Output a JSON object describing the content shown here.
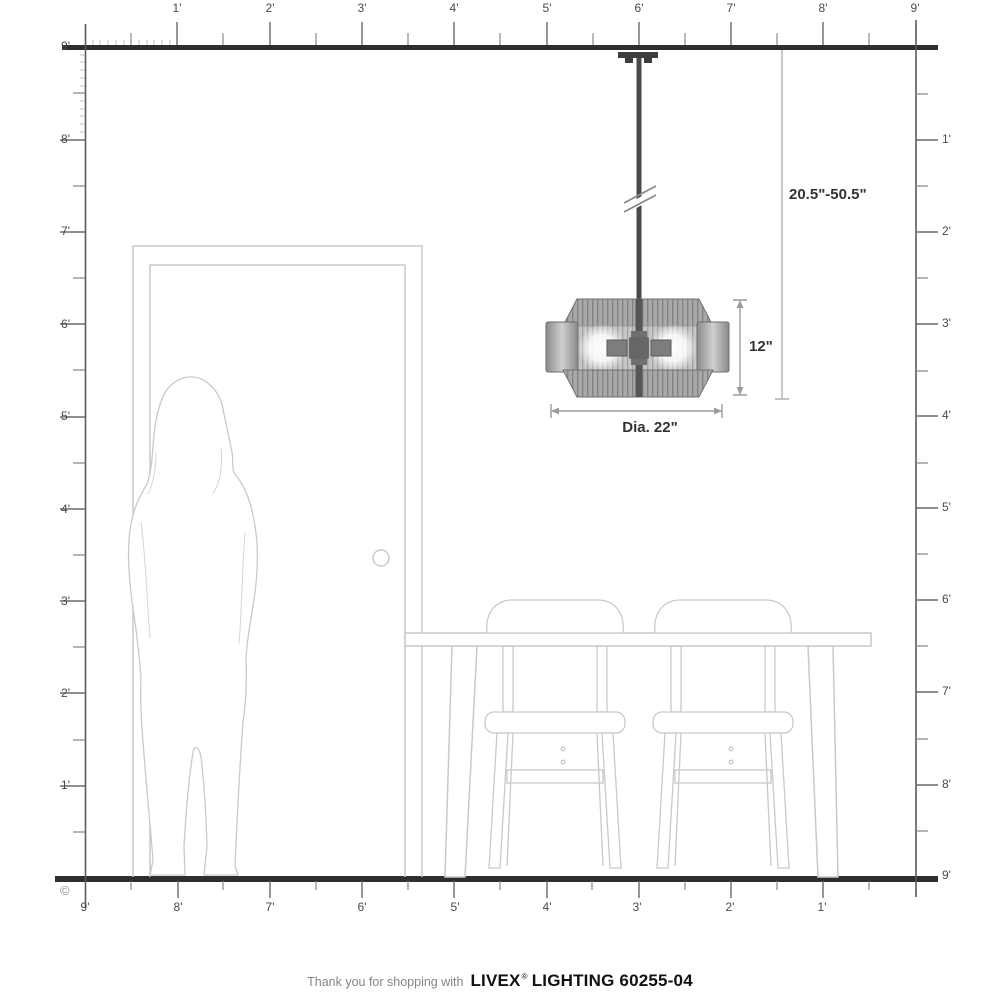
{
  "rulers": {
    "top_labels": [
      "1'",
      "2'",
      "3'",
      "4'",
      "5'",
      "6'",
      "7'",
      "8'",
      "9'"
    ],
    "left_labels": [
      "9'",
      "8'",
      "7'",
      "6'",
      "5'",
      "4'",
      "3'",
      "2'",
      "1'"
    ],
    "right_labels": [
      "1'",
      "2'",
      "3'",
      "4'",
      "5'",
      "6'",
      "7'",
      "8'",
      "9'"
    ],
    "bottom_labels": [
      "9'",
      "8'",
      "7'",
      "6'",
      "5'",
      "4'",
      "3'",
      "2'",
      "1'"
    ],
    "copyright": "©"
  },
  "dimensions": {
    "hang_range": "20.5\"-50.5\"",
    "fixture_height": "12\"",
    "diameter": "Dia. 22\""
  },
  "footer": {
    "prefix": "Thank you for shopping with",
    "brand": "LIVEX",
    "registered": "®",
    "product": "LIGHTING 60255-04"
  },
  "colors": {
    "structure_line": "#2e2e2e",
    "ruler_tick": "#6a6a6a",
    "furniture_line": "#c9c9c9",
    "dimension_line": "#b0b0b0",
    "dimension_text": "#333333",
    "fixture_metal": "#9a9a9a"
  }
}
